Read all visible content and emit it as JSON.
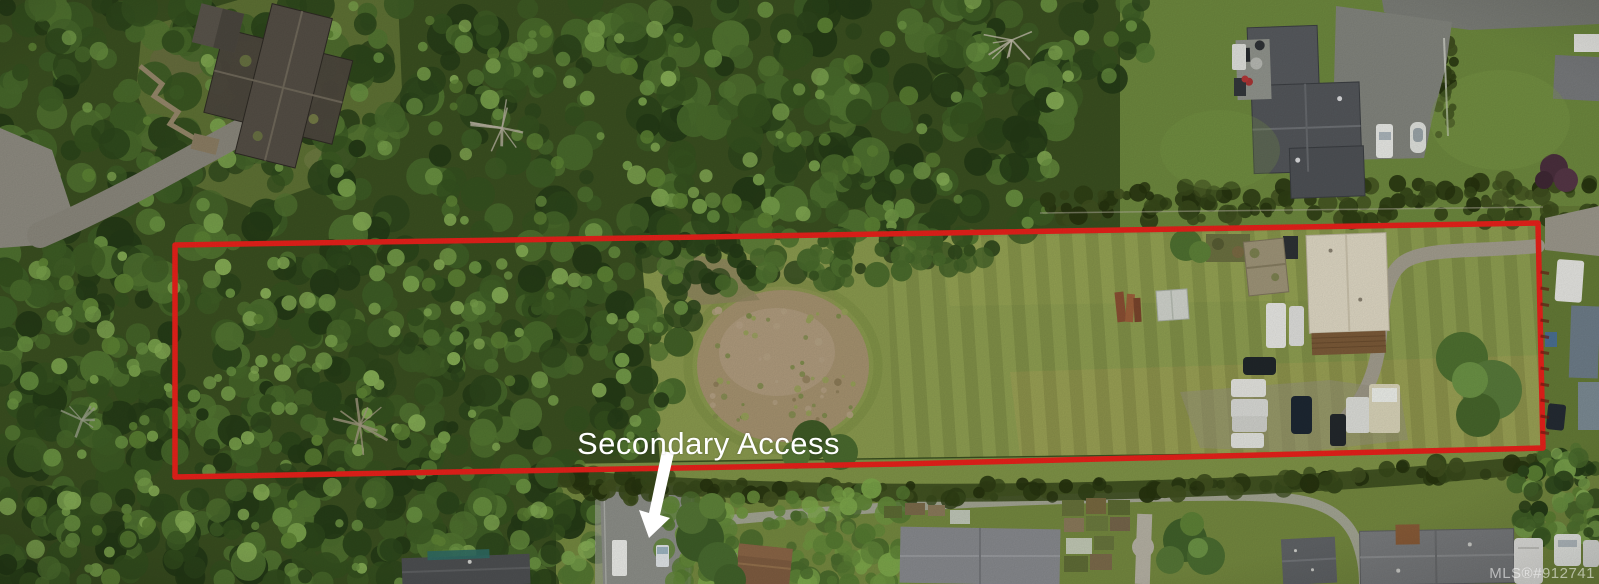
{
  "annotations": {
    "secondary_access": "Secondary Access",
    "watermark": "MLS®#912741"
  },
  "colors": {
    "boundary_red": "#e8211b",
    "annotation_white": "#ffffff"
  }
}
